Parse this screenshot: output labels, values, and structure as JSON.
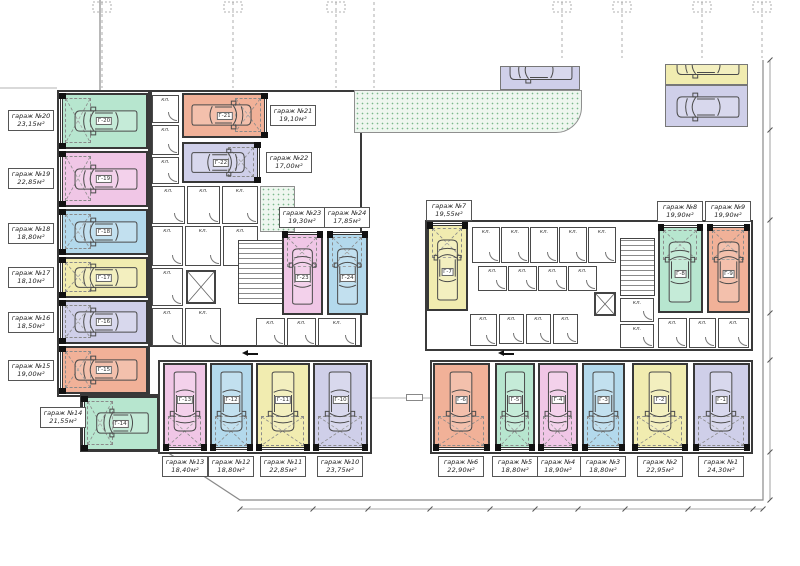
{
  "labels": {
    "storage": "кл."
  },
  "palette": {
    "mint": "#b7e6cf",
    "pink": "#f0c6e6",
    "blue": "#b3d9ec",
    "yellow": "#f1ecb0",
    "lavender": "#cfcfe9",
    "salmon": "#f1b198",
    "wall": "#3a3a3a",
    "boundary": "#8a8a8a",
    "greenery_dot": "#7cb98c"
  },
  "garages": [
    {
      "num": 1,
      "name": "гараж №1",
      "area": "24,30м²",
      "tag": "Г-1",
      "color": "lavender",
      "x": 693,
      "y": 363,
      "w": 57,
      "h": 87,
      "axis": "v",
      "door": "bottom",
      "label": {
        "x": 698,
        "y": 456
      }
    },
    {
      "num": 2,
      "name": "гараж №2",
      "area": "22,95м²",
      "tag": "Г-2",
      "color": "yellow",
      "x": 632,
      "y": 363,
      "w": 56,
      "h": 87,
      "axis": "v",
      "door": "bottom",
      "label": {
        "x": 637,
        "y": 456
      }
    },
    {
      "num": 3,
      "name": "гараж №3",
      "area": "18,80м²",
      "tag": "Г-3",
      "color": "blue",
      "x": 582,
      "y": 363,
      "w": 43,
      "h": 87,
      "axis": "v",
      "door": "bottom",
      "label": {
        "x": 580,
        "y": 456
      }
    },
    {
      "num": 4,
      "name": "гараж №4",
      "area": "18,90м²",
      "tag": "Г-4",
      "color": "pink",
      "x": 538,
      "y": 363,
      "w": 40,
      "h": 87,
      "axis": "v",
      "door": "bottom",
      "label": {
        "x": 535,
        "y": 456
      }
    },
    {
      "num": 5,
      "name": "гараж №5",
      "area": "18,80м²",
      "tag": "Г-5",
      "color": "mint",
      "x": 495,
      "y": 363,
      "w": 40,
      "h": 87,
      "axis": "v",
      "door": "bottom",
      "label": {
        "x": 492,
        "y": 456
      }
    },
    {
      "num": 6,
      "name": "гараж №6",
      "area": "22,90м²",
      "tag": "Г-6",
      "color": "salmon",
      "x": 433,
      "y": 363,
      "w": 57,
      "h": 87,
      "axis": "v",
      "door": "bottom",
      "label": {
        "x": 438,
        "y": 456
      }
    },
    {
      "num": 7,
      "name": "гараж №7",
      "area": "19,55м²",
      "tag": "Г-7",
      "color": "yellow",
      "x": 427,
      "y": 223,
      "w": 41,
      "h": 88,
      "axis": "v",
      "door": "top",
      "label": {
        "x": 426,
        "y": 200
      }
    },
    {
      "num": 8,
      "name": "гараж №8",
      "area": "19,90м²",
      "tag": "Г-8",
      "color": "mint",
      "x": 658,
      "y": 225,
      "w": 45,
      "h": 88,
      "axis": "v",
      "door": "top",
      "label": {
        "x": 657,
        "y": 201
      }
    },
    {
      "num": 9,
      "name": "гараж №9",
      "area": "19,90м²",
      "tag": "Г-9",
      "color": "salmon",
      "x": 707,
      "y": 225,
      "w": 43,
      "h": 88,
      "axis": "v",
      "door": "top",
      "label": {
        "x": 705,
        "y": 201
      }
    },
    {
      "num": 10,
      "name": "гараж №10",
      "area": "23,75м²",
      "tag": "Г-10",
      "color": "lavender",
      "x": 313,
      "y": 363,
      "w": 55,
      "h": 87,
      "axis": "v",
      "door": "bottom",
      "label": {
        "x": 317,
        "y": 456
      }
    },
    {
      "num": 11,
      "name": "гараж №11",
      "area": "22,85м²",
      "tag": "Г-11",
      "color": "yellow",
      "x": 256,
      "y": 363,
      "w": 54,
      "h": 87,
      "axis": "v",
      "door": "bottom",
      "label": {
        "x": 260,
        "y": 456
      }
    },
    {
      "num": 12,
      "name": "гараж №12",
      "area": "18,80м²",
      "tag": "Г-12",
      "color": "blue",
      "x": 210,
      "y": 363,
      "w": 43,
      "h": 87,
      "axis": "v",
      "door": "bottom",
      "label": {
        "x": 208,
        "y": 456
      }
    },
    {
      "num": 13,
      "name": "гараж №13",
      "area": "18,40м²",
      "tag": "Г-13",
      "color": "pink",
      "x": 163,
      "y": 363,
      "w": 44,
      "h": 87,
      "axis": "v",
      "door": "bottom",
      "label": {
        "x": 162,
        "y": 456
      }
    },
    {
      "num": 14,
      "name": "гараж №14",
      "area": "21,55м²",
      "tag": "Г-14",
      "color": "mint",
      "x": 82,
      "y": 396,
      "w": 77,
      "h": 55,
      "axis": "h",
      "door": "left",
      "label": {
        "x": 40,
        "y": 407
      }
    },
    {
      "num": 15,
      "name": "гараж №15",
      "area": "19,00м²",
      "tag": "Г-15",
      "color": "salmon",
      "x": 60,
      "y": 346,
      "w": 88,
      "h": 48,
      "axis": "h",
      "door": "left",
      "label": {
        "x": 8,
        "y": 360
      }
    },
    {
      "num": 16,
      "name": "гараж №16",
      "area": "18,50м²",
      "tag": "Г-16",
      "color": "lavender",
      "x": 60,
      "y": 300,
      "w": 88,
      "h": 44,
      "axis": "h",
      "door": "left",
      "label": {
        "x": 8,
        "y": 312
      }
    },
    {
      "num": 17,
      "name": "гараж №17",
      "area": "18,10м²",
      "tag": "Г-17",
      "color": "yellow",
      "x": 60,
      "y": 257,
      "w": 88,
      "h": 41,
      "axis": "h",
      "door": "left",
      "label": {
        "x": 8,
        "y": 267
      }
    },
    {
      "num": 18,
      "name": "гараж №18",
      "area": "18,80м²",
      "tag": "Г-18",
      "color": "blue",
      "x": 60,
      "y": 209,
      "w": 88,
      "h": 46,
      "axis": "h",
      "door": "left",
      "label": {
        "x": 8,
        "y": 223
      }
    },
    {
      "num": 19,
      "name": "гараж №19",
      "area": "22,85м²",
      "tag": "Г-19",
      "color": "pink",
      "x": 60,
      "y": 151,
      "w": 88,
      "h": 56,
      "axis": "h",
      "door": "left",
      "label": {
        "x": 8,
        "y": 168
      }
    },
    {
      "num": 20,
      "name": "гараж №20",
      "area": "23,15м²",
      "tag": "Г-20",
      "color": "mint",
      "x": 60,
      "y": 93,
      "w": 88,
      "h": 56,
      "axis": "h",
      "door": "left",
      "label": {
        "x": 8,
        "y": 110
      }
    },
    {
      "num": 21,
      "name": "гараж №21",
      "area": "19,10м²",
      "tag": "Г-21",
      "color": "salmon",
      "x": 182,
      "y": 93,
      "w": 85,
      "h": 45,
      "axis": "h",
      "door": "right",
      "label": {
        "x": 270,
        "y": 105
      }
    },
    {
      "num": 22,
      "name": "гараж №22",
      "area": "17,00м²",
      "tag": "Г-22",
      "color": "lavender",
      "x": 182,
      "y": 142,
      "w": 78,
      "h": 41,
      "axis": "h",
      "door": "right",
      "label": {
        "x": 266,
        "y": 152
      }
    },
    {
      "num": 23,
      "name": "гараж №23",
      "area": "19,30м²",
      "tag": "Г-23",
      "color": "pink",
      "x": 282,
      "y": 232,
      "w": 41,
      "h": 83,
      "axis": "v",
      "door": "top",
      "label": {
        "x": 279,
        "y": 207
      }
    },
    {
      "num": 24,
      "name": "гараж №24",
      "area": "17,85м²",
      "tag": "Г-24",
      "color": "blue",
      "x": 327,
      "y": 232,
      "w": 41,
      "h": 83,
      "axis": "v",
      "door": "top",
      "label": {
        "x": 324,
        "y": 207
      }
    }
  ],
  "outdoor": [
    {
      "color": "lavender",
      "x": 500,
      "y": 66,
      "w": 80,
      "h": 24,
      "partial": true
    },
    {
      "color": "yellow",
      "x": 665,
      "y": 64,
      "w": 83,
      "h": 21,
      "partial": true
    },
    {
      "color": "lavender",
      "x": 665,
      "y": 85,
      "w": 83,
      "h": 42,
      "partial": false
    }
  ],
  "blocks": [
    {
      "x": 57,
      "y": 90,
      "w": 93,
      "h": 307
    },
    {
      "x": 80,
      "y": 394,
      "w": 80,
      "h": 58
    },
    {
      "x": 150,
      "y": 90,
      "w": 212,
      "h": 257
    },
    {
      "x": 425,
      "y": 220,
      "w": 328,
      "h": 131
    },
    {
      "x": 158,
      "y": 360,
      "w": 214,
      "h": 94
    },
    {
      "x": 430,
      "y": 360,
      "w": 323,
      "h": 94
    }
  ],
  "rooms": [
    {
      "x": 152,
      "y": 95,
      "w": 27,
      "h": 28
    },
    {
      "x": 152,
      "y": 125,
      "w": 27,
      "h": 30
    },
    {
      "x": 152,
      "y": 157,
      "w": 27,
      "h": 27
    },
    {
      "x": 152,
      "y": 186,
      "w": 33,
      "h": 38
    },
    {
      "x": 187,
      "y": 186,
      "w": 33,
      "h": 38
    },
    {
      "x": 222,
      "y": 186,
      "w": 36,
      "h": 38
    },
    {
      "x": 152,
      "y": 226,
      "w": 31,
      "h": 40
    },
    {
      "x": 152,
      "y": 268,
      "w": 31,
      "h": 38
    },
    {
      "x": 152,
      "y": 308,
      "w": 31,
      "h": 38
    },
    {
      "x": 185,
      "y": 226,
      "w": 36,
      "h": 40
    },
    {
      "x": 223,
      "y": 226,
      "w": 35,
      "h": 40
    },
    {
      "x": 185,
      "y": 308,
      "w": 36,
      "h": 38
    },
    {
      "x": 256,
      "y": 318,
      "w": 29,
      "h": 28
    },
    {
      "x": 287,
      "y": 318,
      "w": 29,
      "h": 28
    },
    {
      "x": 318,
      "y": 318,
      "w": 38,
      "h": 28
    },
    {
      "x": 472,
      "y": 227,
      "w": 28,
      "h": 36
    },
    {
      "x": 501,
      "y": 227,
      "w": 28,
      "h": 36
    },
    {
      "x": 530,
      "y": 227,
      "w": 28,
      "h": 36
    },
    {
      "x": 559,
      "y": 227,
      "w": 28,
      "h": 36
    },
    {
      "x": 588,
      "y": 227,
      "w": 28,
      "h": 36
    },
    {
      "x": 478,
      "y": 266,
      "w": 29,
      "h": 25
    },
    {
      "x": 508,
      "y": 266,
      "w": 29,
      "h": 25
    },
    {
      "x": 538,
      "y": 266,
      "w": 29,
      "h": 25
    },
    {
      "x": 568,
      "y": 266,
      "w": 29,
      "h": 25
    },
    {
      "x": 470,
      "y": 314,
      "w": 27,
      "h": 32
    },
    {
      "x": 499,
      "y": 314,
      "w": 25,
      "h": 30
    },
    {
      "x": 526,
      "y": 314,
      "w": 25,
      "h": 30
    },
    {
      "x": 553,
      "y": 314,
      "w": 25,
      "h": 30
    },
    {
      "x": 620,
      "y": 298,
      "w": 34,
      "h": 24
    },
    {
      "x": 620,
      "y": 324,
      "w": 34,
      "h": 24
    },
    {
      "x": 658,
      "y": 318,
      "w": 29,
      "h": 30
    },
    {
      "x": 689,
      "y": 318,
      "w": 27,
      "h": 30
    },
    {
      "x": 718,
      "y": 318,
      "w": 31,
      "h": 30
    }
  ],
  "stairs": [
    {
      "x": 238,
      "y": 240,
      "w": 48,
      "h": 64
    },
    {
      "x": 620,
      "y": 238,
      "w": 35,
      "h": 58
    }
  ],
  "lifts": [
    {
      "x": 186,
      "y": 270,
      "w": 30,
      "h": 34
    },
    {
      "x": 594,
      "y": 292,
      "w": 22,
      "h": 24
    }
  ],
  "green": [
    {
      "x": 354,
      "y": 90,
      "w": 228,
      "h": 43,
      "round": true
    },
    {
      "x": 260,
      "y": 186,
      "w": 35,
      "h": 46,
      "round": false
    }
  ],
  "exits": [
    {
      "x": 242,
      "y": 350
    },
    {
      "x": 498,
      "y": 350
    }
  ],
  "dimtags": [
    {
      "x": 406,
      "y": 394,
      "w": 17,
      "h": 7
    }
  ]
}
